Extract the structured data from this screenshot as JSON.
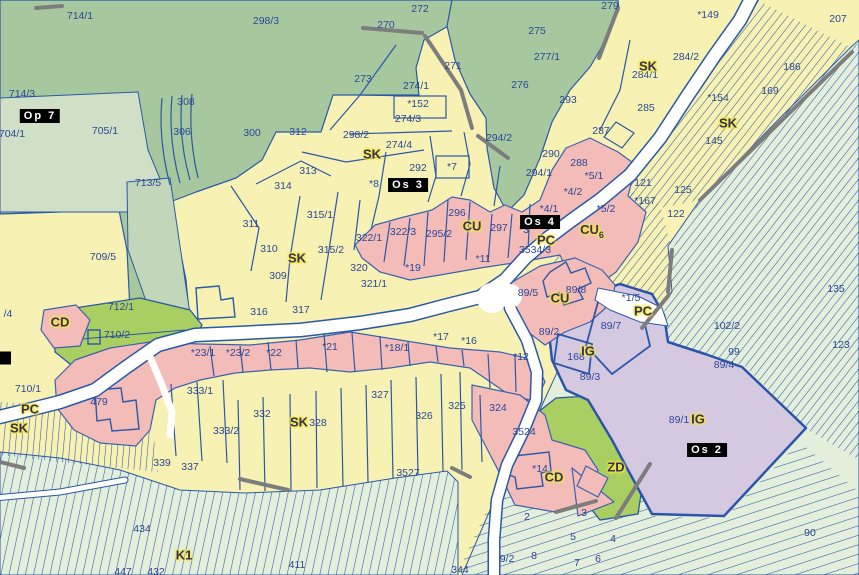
{
  "map": {
    "palette": {
      "forest_green": "#a7c89f",
      "forest_light": "#cfe0c6",
      "field_green": "#e3eedb",
      "parcel_yellow": "#f7f2b4",
      "builtup_pink": "#f3bcb8",
      "industrial_purple": "#d5c9e2",
      "garden_green": "#a9cf63",
      "road_white": "#ffffff",
      "boundary_blue": "#2a58a8",
      "boundary_gray": "#7d7d7d",
      "parcel_label_blue": "#2b4795",
      "zone_label_halo": "#f7e642",
      "designation_bg": "#000000",
      "designation_fg": "#ffffff"
    },
    "labels": {
      "parcels": [
        {
          "text": "714/1",
          "x": 80,
          "y": 16
        },
        {
          "text": "298/3",
          "x": 266,
          "y": 21
        },
        {
          "text": "272",
          "x": 420,
          "y": 9
        },
        {
          "text": "270",
          "x": 386,
          "y": 25
        },
        {
          "text": "275",
          "x": 537,
          "y": 31
        },
        {
          "text": "279",
          "x": 610,
          "y": 6
        },
        {
          "text": "*149",
          "x": 708,
          "y": 15
        },
        {
          "text": "207",
          "x": 838,
          "y": 19
        },
        {
          "text": "271",
          "x": 453,
          "y": 66
        },
        {
          "text": "277/1",
          "x": 547,
          "y": 57
        },
        {
          "text": "273",
          "x": 363,
          "y": 79
        },
        {
          "text": "274/1",
          "x": 416,
          "y": 86
        },
        {
          "text": "*152",
          "x": 418,
          "y": 104
        },
        {
          "text": "276",
          "x": 520,
          "y": 85
        },
        {
          "text": "284/2",
          "x": 686,
          "y": 57
        },
        {
          "text": "284/1",
          "x": 645,
          "y": 75
        },
        {
          "text": "293",
          "x": 568,
          "y": 100
        },
        {
          "text": "186",
          "x": 792,
          "y": 67
        },
        {
          "text": "169",
          "x": 770,
          "y": 91
        },
        {
          "text": "*154",
          "x": 718,
          "y": 98
        },
        {
          "text": "145",
          "x": 714,
          "y": 141
        },
        {
          "text": "285",
          "x": 646,
          "y": 108
        },
        {
          "text": "287",
          "x": 601,
          "y": 131
        },
        {
          "text": "308",
          "x": 186,
          "y": 102
        },
        {
          "text": "306",
          "x": 182,
          "y": 132
        },
        {
          "text": "300",
          "x": 252,
          "y": 133
        },
        {
          "text": "714/3",
          "x": 22,
          "y": 94
        },
        {
          "text": "704/1",
          "x": 12,
          "y": 134
        },
        {
          "text": "705/1",
          "x": 105,
          "y": 131
        },
        {
          "text": "713/5",
          "x": 148,
          "y": 183
        },
        {
          "text": "312",
          "x": 298,
          "y": 132
        },
        {
          "text": "313",
          "x": 308,
          "y": 171
        },
        {
          "text": "298/2",
          "x": 356,
          "y": 135
        },
        {
          "text": "274/4",
          "x": 399,
          "y": 145
        },
        {
          "text": "274/3",
          "x": 408,
          "y": 119
        },
        {
          "text": "292",
          "x": 418,
          "y": 168
        },
        {
          "text": "*7",
          "x": 452,
          "y": 167
        },
        {
          "text": "*8",
          "x": 374,
          "y": 184
        },
        {
          "text": "314",
          "x": 283,
          "y": 186
        },
        {
          "text": "311",
          "x": 251,
          "y": 224
        },
        {
          "text": "310",
          "x": 269,
          "y": 249
        },
        {
          "text": "309",
          "x": 278,
          "y": 276
        },
        {
          "text": "316",
          "x": 259,
          "y": 312
        },
        {
          "text": "315/1",
          "x": 320,
          "y": 215
        },
        {
          "text": "315/2",
          "x": 331,
          "y": 250
        },
        {
          "text": "322/1",
          "x": 369,
          "y": 238
        },
        {
          "text": "320",
          "x": 359,
          "y": 268
        },
        {
          "text": "321/1",
          "x": 374,
          "y": 284
        },
        {
          "text": "317",
          "x": 301,
          "y": 310
        },
        {
          "text": "322/3",
          "x": 403,
          "y": 232
        },
        {
          "text": "295/2",
          "x": 439,
          "y": 234
        },
        {
          "text": "296",
          "x": 457,
          "y": 213
        },
        {
          "text": "297",
          "x": 499,
          "y": 228
        },
        {
          "text": "*3",
          "x": 524,
          "y": 230
        },
        {
          "text": "*19",
          "x": 413,
          "y": 268
        },
        {
          "text": "*11",
          "x": 483,
          "y": 259
        },
        {
          "text": "709/5",
          "x": 103,
          "y": 257
        },
        {
          "text": "712/1",
          "x": 121,
          "y": 307
        },
        {
          "text": "710/2",
          "x": 117,
          "y": 335
        },
        {
          "text": "/4",
          "x": 8,
          "y": 314
        },
        {
          "text": "89/5",
          "x": 528,
          "y": 293
        },
        {
          "text": "89/8",
          "x": 576,
          "y": 290
        },
        {
          "text": "89/2",
          "x": 549,
          "y": 332
        },
        {
          "text": "89/7",
          "x": 611,
          "y": 326
        },
        {
          "text": "*1/5",
          "x": 631,
          "y": 298
        },
        {
          "text": "3534/3",
          "x": 535,
          "y": 250
        },
        {
          "text": "*4/1",
          "x": 549,
          "y": 209
        },
        {
          "text": "*4/2",
          "x": 573,
          "y": 192
        },
        {
          "text": "*5/1",
          "x": 594,
          "y": 176
        },
        {
          "text": "288",
          "x": 579,
          "y": 163
        },
        {
          "text": "290",
          "x": 551,
          "y": 154
        },
        {
          "text": "294/1",
          "x": 539,
          "y": 173
        },
        {
          "text": "294/2",
          "x": 499,
          "y": 138
        },
        {
          "text": "*5/2",
          "x": 606,
          "y": 209
        },
        {
          "text": "121",
          "x": 643,
          "y": 183
        },
        {
          "text": "125",
          "x": 683,
          "y": 190
        },
        {
          "text": "*167",
          "x": 645,
          "y": 201
        },
        {
          "text": "122",
          "x": 676,
          "y": 214
        },
        {
          "text": "135",
          "x": 836,
          "y": 289
        },
        {
          "text": "102/2",
          "x": 727,
          "y": 326
        },
        {
          "text": "99",
          "x": 734,
          "y": 352
        },
        {
          "text": "89/4",
          "x": 724,
          "y": 365
        },
        {
          "text": "123",
          "x": 841,
          "y": 345
        },
        {
          "text": "168",
          "x": 576,
          "y": 357
        },
        {
          "text": "89/3",
          "x": 590,
          "y": 377
        },
        {
          "text": "*12",
          "x": 521,
          "y": 357
        },
        {
          "text": "*16",
          "x": 469,
          "y": 341
        },
        {
          "text": "*17",
          "x": 441,
          "y": 337
        },
        {
          "text": "*18/1",
          "x": 397,
          "y": 348
        },
        {
          "text": "*21",
          "x": 330,
          "y": 347
        },
        {
          "text": "*22",
          "x": 274,
          "y": 353
        },
        {
          "text": "*23/2",
          "x": 238,
          "y": 353
        },
        {
          "text": "*23/1",
          "x": 203,
          "y": 353
        },
        {
          "text": "710/1",
          "x": 28,
          "y": 389
        },
        {
          "text": "479",
          "x": 99,
          "y": 402
        },
        {
          "text": "333/1",
          "x": 200,
          "y": 391
        },
        {
          "text": "333/2",
          "x": 226,
          "y": 431
        },
        {
          "text": "332",
          "x": 262,
          "y": 414
        },
        {
          "text": "339",
          "x": 162,
          "y": 463
        },
        {
          "text": "337",
          "x": 190,
          "y": 467
        },
        {
          "text": "328",
          "x": 318,
          "y": 423
        },
        {
          "text": "327",
          "x": 380,
          "y": 395
        },
        {
          "text": "326",
          "x": 424,
          "y": 416
        },
        {
          "text": "325",
          "x": 457,
          "y": 406
        },
        {
          "text": "324",
          "x": 498,
          "y": 408
        },
        {
          "text": "3524",
          "x": 524,
          "y": 432
        },
        {
          "text": "*14",
          "x": 540,
          "y": 469
        },
        {
          "text": "3527",
          "x": 408,
          "y": 473
        },
        {
          "text": "2",
          "x": 527,
          "y": 517
        },
        {
          "text": "3",
          "x": 584,
          "y": 513
        },
        {
          "text": "5",
          "x": 573,
          "y": 537
        },
        {
          "text": "4",
          "x": 613,
          "y": 539
        },
        {
          "text": "9/2",
          "x": 507,
          "y": 559
        },
        {
          "text": "8",
          "x": 534,
          "y": 556
        },
        {
          "text": "6",
          "x": 598,
          "y": 559
        },
        {
          "text": "7",
          "x": 577,
          "y": 563
        },
        {
          "text": "344",
          "x": 460,
          "y": 570
        },
        {
          "text": "90",
          "x": 810,
          "y": 533
        },
        {
          "text": "89/1",
          "x": 679,
          "y": 420
        },
        {
          "text": "411",
          "x": 297,
          "y": 565
        },
        {
          "text": "434",
          "x": 142,
          "y": 529
        },
        {
          "text": "447",
          "x": 123,
          "y": 572
        },
        {
          "text": "432",
          "x": 156,
          "y": 572
        }
      ],
      "zones": [
        {
          "text": "SK",
          "x": 372,
          "y": 154
        },
        {
          "text": "SK",
          "x": 297,
          "y": 258
        },
        {
          "text": "SK",
          "x": 648,
          "y": 66
        },
        {
          "text": "SK",
          "x": 728,
          "y": 123
        },
        {
          "text": "SK",
          "x": 19,
          "y": 428
        },
        {
          "text": "SK",
          "x": 299,
          "y": 422
        },
        {
          "text": "CU",
          "x": 472,
          "y": 226
        },
        {
          "text": "CU",
          "x": 560,
          "y": 298
        },
        {
          "text": "CU",
          "sub": "6",
          "x": 592,
          "y": 231
        },
        {
          "text": "PC",
          "x": 546,
          "y": 240
        },
        {
          "text": "PC",
          "x": 643,
          "y": 311
        },
        {
          "text": "PC",
          "x": 30,
          "y": 409
        },
        {
          "text": "IG",
          "x": 588,
          "y": 351
        },
        {
          "text": "IG",
          "x": 698,
          "y": 419
        },
        {
          "text": "CD",
          "x": 60,
          "y": 322
        },
        {
          "text": "CD",
          "x": 554,
          "y": 477
        },
        {
          "text": "ZD",
          "x": 616,
          "y": 467
        },
        {
          "text": "K1",
          "x": 184,
          "y": 555
        }
      ],
      "designations": [
        {
          "text": "Op 7",
          "x": 40,
          "y": 116
        },
        {
          "text": "Os 3",
          "x": 408,
          "y": 185
        },
        {
          "text": "Os 4",
          "x": 540,
          "y": 222
        },
        {
          "text": "Os 2",
          "x": 707,
          "y": 450
        },
        {
          "text": "",
          "x": 4,
          "y": 358
        }
      ]
    }
  }
}
